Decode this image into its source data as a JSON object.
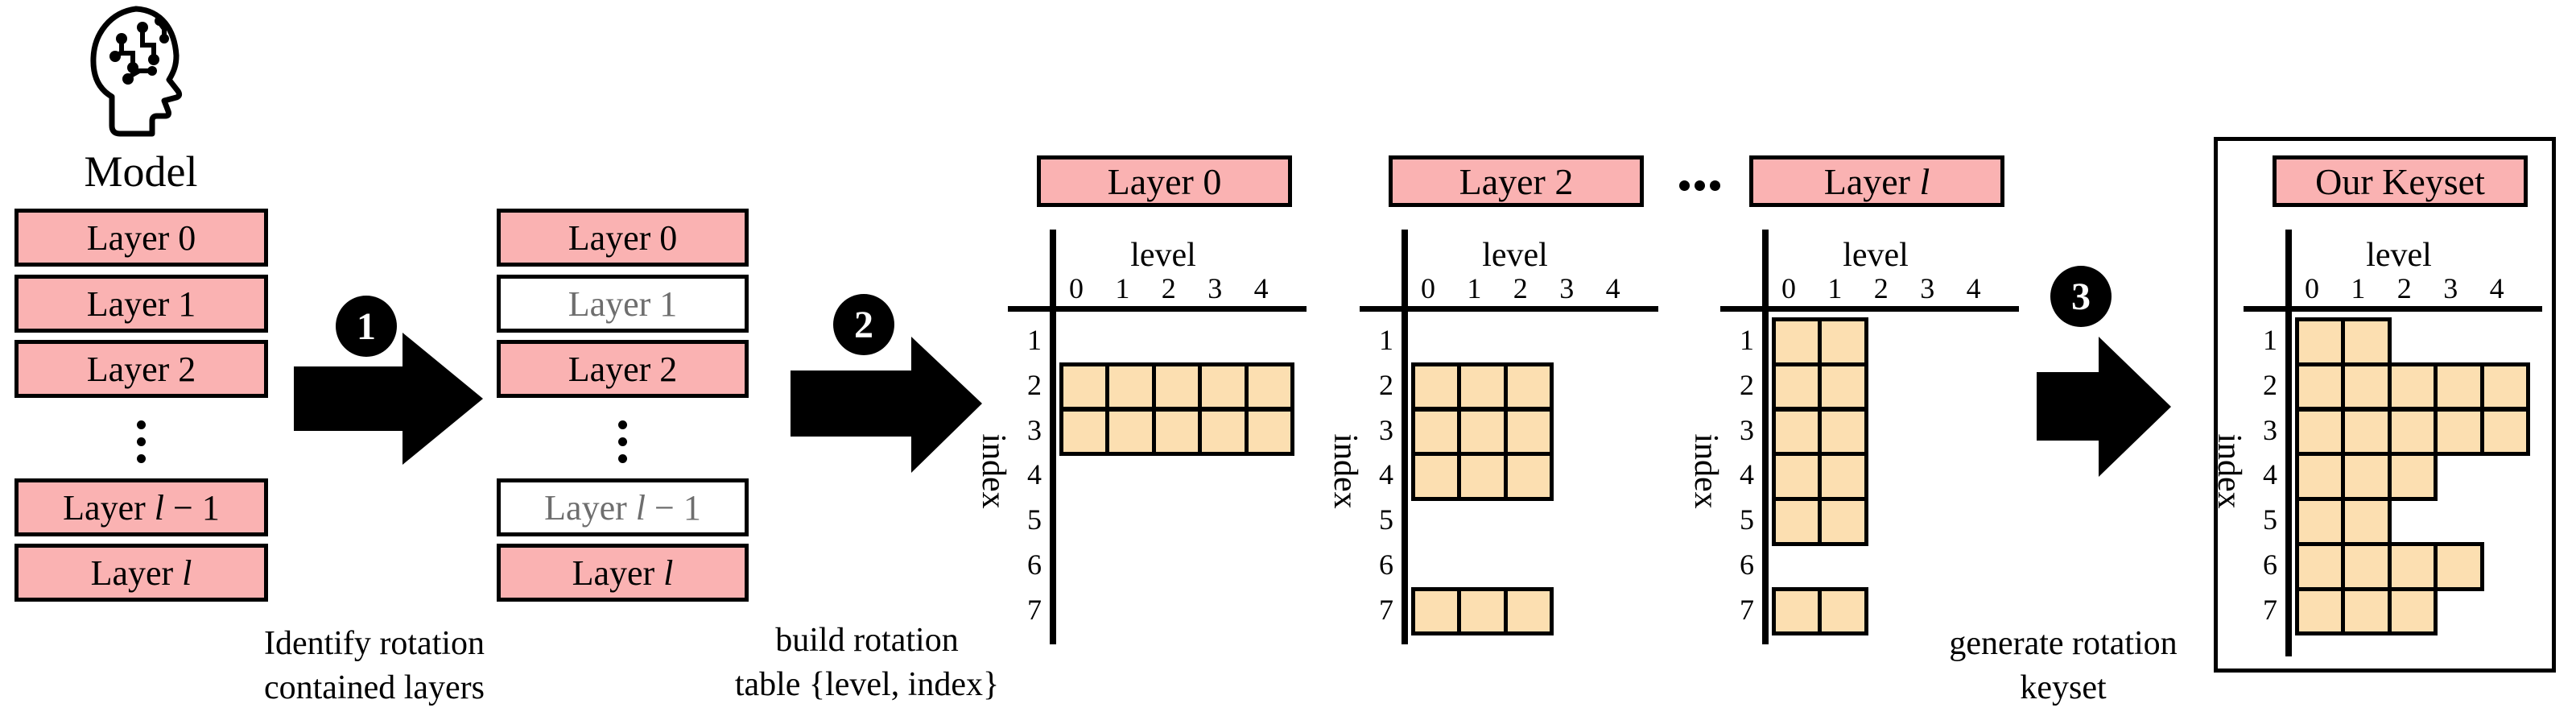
{
  "colors": {
    "pink": "#FAB2B2",
    "cell_fill": "#FCDFB1",
    "excluded_text": "#6E6E6E",
    "line": "#000000"
  },
  "model": {
    "label": "Model",
    "icon": "brain-circuit-head-icon"
  },
  "left_stack": {
    "items": [
      {
        "prefix": "Layer 0",
        "math": "",
        "suffix": "",
        "excluded": false
      },
      {
        "prefix": "Layer 1",
        "math": "",
        "suffix": "",
        "excluded": false
      },
      {
        "prefix": "Layer 2",
        "math": "",
        "suffix": "",
        "excluded": false
      },
      {
        "kind": "ellipsis",
        "icon": "vertical-ellipsis-icon"
      },
      {
        "prefix": "Layer ",
        "math": "l",
        "suffix": " − 1",
        "excluded": false
      },
      {
        "prefix": "Layer ",
        "math": "l",
        "suffix": "",
        "excluded": false
      }
    ]
  },
  "right_stack": {
    "items": [
      {
        "prefix": "Layer 0",
        "math": "",
        "suffix": "",
        "excluded": false
      },
      {
        "prefix": "Layer 1",
        "math": "",
        "suffix": "",
        "excluded": true
      },
      {
        "prefix": "Layer 2",
        "math": "",
        "suffix": "",
        "excluded": false
      },
      {
        "kind": "ellipsis",
        "icon": "vertical-ellipsis-icon"
      },
      {
        "prefix": "Layer ",
        "math": "l",
        "suffix": " − 1",
        "excluded": true
      },
      {
        "prefix": "Layer ",
        "math": "l",
        "suffix": "",
        "excluded": false
      }
    ]
  },
  "steps": [
    {
      "number": "1",
      "caption_line1": "Identify rotation",
      "caption_line2": "contained layers"
    },
    {
      "number": "2",
      "caption_line1": "build rotation",
      "caption_line2": "table {level, index}"
    },
    {
      "number": "3",
      "caption_line1": "generate rotation",
      "caption_line2": "keyset"
    }
  ],
  "table_axis": {
    "x_label": "level",
    "y_label": "index",
    "columns": [
      "0",
      "1",
      "2",
      "3",
      "4"
    ],
    "rows": [
      "1",
      "2",
      "3",
      "4",
      "5",
      "6",
      "7"
    ]
  },
  "ellipsis_between_tables": {
    "icon": "horizontal-ellipsis-icon"
  },
  "tables": [
    {
      "title_prefix": "Layer 0",
      "title_math": "",
      "filled_cells": [
        [
          2,
          0
        ],
        [
          2,
          1
        ],
        [
          2,
          2
        ],
        [
          2,
          3
        ],
        [
          2,
          4
        ],
        [
          3,
          0
        ],
        [
          3,
          1
        ],
        [
          3,
          2
        ],
        [
          3,
          3
        ],
        [
          3,
          4
        ]
      ]
    },
    {
      "title_prefix": "Layer 2",
      "title_math": "",
      "filled_cells": [
        [
          2,
          0
        ],
        [
          2,
          1
        ],
        [
          2,
          2
        ],
        [
          3,
          0
        ],
        [
          3,
          1
        ],
        [
          3,
          2
        ],
        [
          4,
          0
        ],
        [
          4,
          1
        ],
        [
          4,
          2
        ],
        [
          7,
          0
        ],
        [
          7,
          1
        ],
        [
          7,
          2
        ]
      ]
    },
    {
      "title_prefix": "Layer ",
      "title_math": "l",
      "filled_cells": [
        [
          1,
          0
        ],
        [
          1,
          1
        ],
        [
          2,
          0
        ],
        [
          2,
          1
        ],
        [
          3,
          0
        ],
        [
          3,
          1
        ],
        [
          4,
          0
        ],
        [
          4,
          1
        ],
        [
          5,
          0
        ],
        [
          5,
          1
        ],
        [
          7,
          0
        ],
        [
          7,
          1
        ]
      ]
    }
  ],
  "keyset": {
    "title_prefix": "Our Keyset",
    "title_math": "",
    "filled_cells": [
      [
        1,
        0
      ],
      [
        1,
        1
      ],
      [
        2,
        0
      ],
      [
        2,
        1
      ],
      [
        2,
        2
      ],
      [
        2,
        3
      ],
      [
        2,
        4
      ],
      [
        3,
        0
      ],
      [
        3,
        1
      ],
      [
        3,
        2
      ],
      [
        3,
        3
      ],
      [
        3,
        4
      ],
      [
        4,
        0
      ],
      [
        4,
        1
      ],
      [
        4,
        2
      ],
      [
        5,
        0
      ],
      [
        5,
        1
      ],
      [
        6,
        0
      ],
      [
        6,
        1
      ],
      [
        6,
        2
      ],
      [
        6,
        3
      ],
      [
        7,
        0
      ],
      [
        7,
        1
      ],
      [
        7,
        2
      ]
    ]
  }
}
